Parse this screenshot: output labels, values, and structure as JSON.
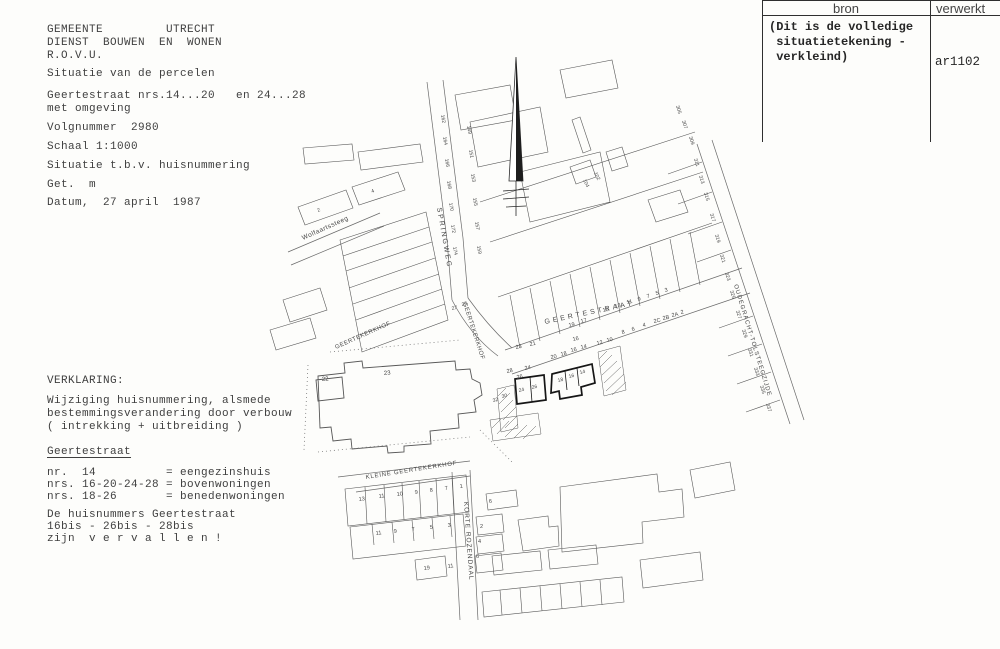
{
  "colors": {
    "ink": "#3a3a3a",
    "map_line": "#5c5c5c",
    "bold_parcel": "#161616",
    "paper": "#fdfdfb"
  },
  "left_top": {
    "lines": [
      "GEMEENTE         UTRECHT",
      "DIENST  BOUWEN  EN  WONEN",
      "R.O.V.U.",
      "Situatie van de percelen",
      "Geertestraat nrs.14...20   en 24...28",
      "met omgeving",
      "Volgnummer  2980",
      "Schaal 1:1000",
      "Situatie t.b.v. huisnummering",
      "Get.  m",
      "Datum,  27 april  1987"
    ]
  },
  "left_bottom": {
    "lines": [
      "VERKLARING:",
      "Wijziging huisnummering, alsmede",
      "bestemmingsverandering door verbouw",
      "( intrekking + uitbreiding )",
      "Geertestraat",
      "nr.  14          = eengezinshuis",
      "nrs. 16-20-24-28 = bovenwoningen",
      "nrs. 18-26       = benedenwoningen",
      "De huisnummers Geertestraat",
      "16bis - 26bis - 28bis",
      "zijn  v e r v a l l e n !"
    ]
  },
  "ref_table": {
    "col1_header": "bron",
    "col2_header": "verwerkt",
    "note_lines": "(Dit is de volledige\n situatietekening -\n verkleind)",
    "value": "ar1102"
  },
  "map": {
    "street_labels": [
      {
        "text": "SPRINGWEG",
        "x": 437,
        "y": 208,
        "rot": 80,
        "size": 7,
        "spacing": 2
      },
      {
        "text": "GEERTEKERKHOF",
        "x": 463,
        "y": 303,
        "rot": 72,
        "size": 6,
        "spacing": 0.5
      },
      {
        "text": "GEERTEKERKHOF",
        "x": 336,
        "y": 349,
        "rot": -24,
        "size": 6,
        "spacing": 0.5
      },
      {
        "text": "GEERTESTRAAT",
        "x": 545,
        "y": 324,
        "rot": -12,
        "size": 7,
        "spacing": 3
      },
      {
        "text": "KLEINE GEERTEKERKHOF",
        "x": 366,
        "y": 479,
        "rot": -9,
        "size": 6,
        "spacing": 0.8
      },
      {
        "text": "KORTE ROZENDAAL",
        "x": 464,
        "y": 502,
        "rot": 86,
        "size": 6.5,
        "spacing": 1
      },
      {
        "text": "OUDEGRACHT-TOLSTEEGZIJDE",
        "x": 734,
        "y": 285,
        "rot": 73,
        "size": 6,
        "spacing": 1
      },
      {
        "text": "Wolfaartssteeg",
        "x": 303,
        "y": 240,
        "rot": -24,
        "size": 6.5,
        "spacing": 0.5
      }
    ],
    "parcel_labels": [
      {
        "t": "23",
        "x": 516,
        "y": 349,
        "r": -12
      },
      {
        "t": "21",
        "x": 530,
        "y": 346,
        "r": -12
      },
      {
        "t": "19",
        "x": 569,
        "y": 327,
        "r": -12
      },
      {
        "t": "17",
        "x": 581,
        "y": 323,
        "r": -12
      },
      {
        "t": "15",
        "x": 603,
        "y": 312,
        "r": -12
      },
      {
        "t": "13",
        "x": 615,
        "y": 308,
        "r": -12
      },
      {
        "t": "11",
        "x": 627,
        "y": 304,
        "r": -12
      },
      {
        "t": "9",
        "x": 638,
        "y": 301,
        "r": -12
      },
      {
        "t": "7",
        "x": 647,
        "y": 298,
        "r": -12
      },
      {
        "t": "5",
        "x": 656,
        "y": 295,
        "r": -12
      },
      {
        "t": "3",
        "x": 665,
        "y": 292,
        "r": -12
      },
      {
        "t": "12",
        "x": 597,
        "y": 345,
        "r": -12
      },
      {
        "t": "10",
        "x": 607,
        "y": 342,
        "r": -12
      },
      {
        "t": "8",
        "x": 622,
        "y": 334,
        "r": -12
      },
      {
        "t": "6",
        "x": 632,
        "y": 331,
        "r": -12
      },
      {
        "t": "4",
        "x": 643,
        "y": 327,
        "r": -12
      },
      {
        "t": "2C",
        "x": 654,
        "y": 323,
        "r": -12
      },
      {
        "t": "2B",
        "x": 663,
        "y": 320,
        "r": -12
      },
      {
        "t": "2A",
        "x": 672,
        "y": 317,
        "r": -12
      },
      {
        "t": "2",
        "x": 681,
        "y": 314,
        "r": -12
      },
      {
        "t": "28",
        "x": 507,
        "y": 373,
        "r": -12
      },
      {
        "t": "26",
        "x": 517,
        "y": 379,
        "r": -12
      },
      {
        "t": "24",
        "x": 525,
        "y": 370,
        "r": -12
      },
      {
        "t": "20",
        "x": 551,
        "y": 359,
        "r": -12
      },
      {
        "t": "18",
        "x": 561,
        "y": 356,
        "r": -12
      },
      {
        "t": "16",
        "x": 571,
        "y": 352,
        "r": -12
      },
      {
        "t": "14",
        "x": 581,
        "y": 349,
        "r": -12
      },
      {
        "t": "16",
        "x": 573,
        "y": 341,
        "r": -12
      },
      {
        "t": "24",
        "x": 519,
        "y": 392,
        "r": -12,
        "s": 5
      },
      {
        "t": "26",
        "x": 532,
        "y": 389,
        "r": -12,
        "s": 5
      },
      {
        "t": "18",
        "x": 558,
        "y": 382,
        "r": -12,
        "s": 5
      },
      {
        "t": "16",
        "x": 569,
        "y": 378,
        "r": -12,
        "s": 5
      },
      {
        "t": "14",
        "x": 580,
        "y": 374,
        "r": -12,
        "s": 5
      },
      {
        "t": "30",
        "x": 502,
        "y": 398,
        "r": -12,
        "s": 5
      },
      {
        "t": "32",
        "x": 493,
        "y": 402,
        "r": -12,
        "s": 5
      },
      {
        "t": "27",
        "x": 452,
        "y": 310,
        "r": -12,
        "s": 5
      },
      {
        "t": "25",
        "x": 462,
        "y": 306,
        "r": -12,
        "s": 5
      },
      {
        "t": "23",
        "x": 384,
        "y": 375,
        "r": -5,
        "s": 6
      },
      {
        "t": "22",
        "x": 322,
        "y": 381,
        "r": -5,
        "s": 6
      },
      {
        "t": "13",
        "x": 359,
        "y": 501,
        "r": -8
      },
      {
        "t": "11",
        "x": 379,
        "y": 498,
        "r": -8
      },
      {
        "t": "10",
        "x": 397,
        "y": 496,
        "r": -8
      },
      {
        "t": "9",
        "x": 415,
        "y": 494,
        "r": -8
      },
      {
        "t": "8",
        "x": 430,
        "y": 492,
        "r": -8
      },
      {
        "t": "7",
        "x": 445,
        "y": 490,
        "r": -8
      },
      {
        "t": "1",
        "x": 460,
        "y": 488,
        "r": -8
      },
      {
        "t": "11",
        "x": 376,
        "y": 535,
        "r": -8
      },
      {
        "t": "9",
        "x": 394,
        "y": 533,
        "r": -8
      },
      {
        "t": "7",
        "x": 412,
        "y": 531,
        "r": -8
      },
      {
        "t": "5",
        "x": 430,
        "y": 529,
        "r": -8
      },
      {
        "t": "3",
        "x": 448,
        "y": 527,
        "r": -8
      },
      {
        "t": "19",
        "x": 424,
        "y": 570,
        "r": -8
      },
      {
        "t": "11",
        "x": 448,
        "y": 568,
        "r": -8
      },
      {
        "t": "6",
        "x": 489,
        "y": 503,
        "r": -5
      },
      {
        "t": "2",
        "x": 480,
        "y": 528,
        "r": 0
      },
      {
        "t": "4",
        "x": 478,
        "y": 543,
        "r": 0
      },
      {
        "t": "6",
        "x": 476,
        "y": 558,
        "r": 0
      },
      {
        "t": "305",
        "x": 676,
        "y": 106,
        "r": 73,
        "s": 5
      },
      {
        "t": "307",
        "x": 682,
        "y": 121,
        "r": 73,
        "s": 5
      },
      {
        "t": "309",
        "x": 689,
        "y": 137,
        "r": 73,
        "s": 5
      },
      {
        "t": "311",
        "x": 694,
        "y": 159,
        "r": 73,
        "s": 5
      },
      {
        "t": "313",
        "x": 699,
        "y": 176,
        "r": 73,
        "s": 5
      },
      {
        "t": "315",
        "x": 704,
        "y": 193,
        "r": 73,
        "s": 5
      },
      {
        "t": "317",
        "x": 710,
        "y": 214,
        "r": 73,
        "s": 5
      },
      {
        "t": "319",
        "x": 715,
        "y": 235,
        "r": 73,
        "s": 5
      },
      {
        "t": "321",
        "x": 720,
        "y": 255,
        "r": 73,
        "s": 5
      },
      {
        "t": "323",
        "x": 725,
        "y": 273,
        "r": 73,
        "s": 5
      },
      {
        "t": "325",
        "x": 730,
        "y": 291,
        "r": 73,
        "s": 5
      },
      {
        "t": "327",
        "x": 736,
        "y": 311,
        "r": 73,
        "s": 5
      },
      {
        "t": "329",
        "x": 742,
        "y": 330,
        "r": 73,
        "s": 5
      },
      {
        "t": "331",
        "x": 748,
        "y": 349,
        "r": 73,
        "s": 5
      },
      {
        "t": "333",
        "x": 754,
        "y": 368,
        "r": 73,
        "s": 5
      },
      {
        "t": "335",
        "x": 760,
        "y": 386,
        "r": 73,
        "s": 5
      },
      {
        "t": "337",
        "x": 766,
        "y": 404,
        "r": 73,
        "s": 5
      },
      {
        "t": "162",
        "x": 441,
        "y": 115,
        "r": 80,
        "s": 5
      },
      {
        "t": "164",
        "x": 443,
        "y": 137,
        "r": 80,
        "s": 5
      },
      {
        "t": "166",
        "x": 445,
        "y": 159,
        "r": 80,
        "s": 5
      },
      {
        "t": "168",
        "x": 447,
        "y": 181,
        "r": 80,
        "s": 5
      },
      {
        "t": "170",
        "x": 449,
        "y": 203,
        "r": 80,
        "s": 5
      },
      {
        "t": "172",
        "x": 451,
        "y": 225,
        "r": 80,
        "s": 5
      },
      {
        "t": "174",
        "x": 453,
        "y": 247,
        "r": 80,
        "s": 5
      },
      {
        "t": "149",
        "x": 467,
        "y": 126,
        "r": 80,
        "s": 5
      },
      {
        "t": "151",
        "x": 469,
        "y": 150,
        "r": 80,
        "s": 5
      },
      {
        "t": "153",
        "x": 471,
        "y": 174,
        "r": 80,
        "s": 5
      },
      {
        "t": "155",
        "x": 473,
        "y": 198,
        "r": 80,
        "s": 5
      },
      {
        "t": "157",
        "x": 475,
        "y": 222,
        "r": 80,
        "s": 5
      },
      {
        "t": "159",
        "x": 477,
        "y": 246,
        "r": 80,
        "s": 5
      },
      {
        "t": "104",
        "x": 583,
        "y": 180,
        "r": 65,
        "s": 5
      },
      {
        "t": "102",
        "x": 594,
        "y": 173,
        "r": 65,
        "s": 5
      },
      {
        "t": "2",
        "x": 318,
        "y": 212,
        "r": -22,
        "s": 5
      },
      {
        "t": "4",
        "x": 372,
        "y": 193,
        "r": -22,
        "s": 5
      }
    ]
  }
}
